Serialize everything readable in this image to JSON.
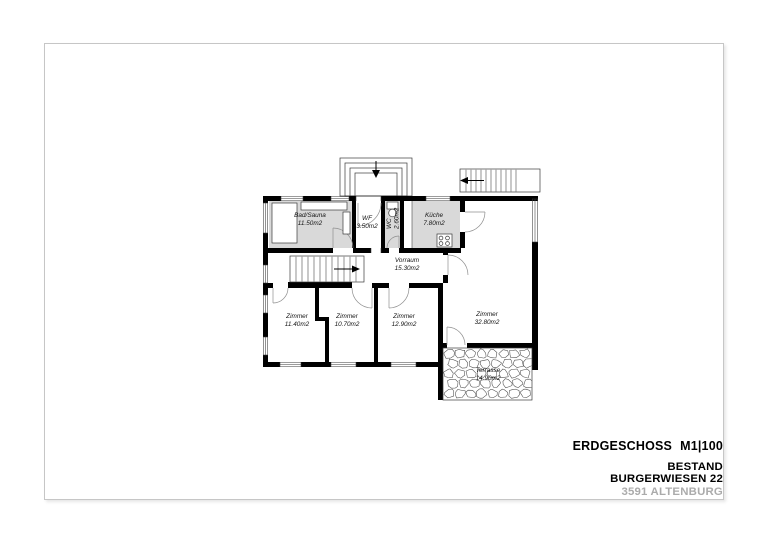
{
  "title_block": {
    "floor_label": "ERDGESCHOSS",
    "scale_label": "M1|100",
    "status_label": "BESTAND",
    "address_street": "BURGERWIESEN 22",
    "address_city": "3591 ALTENBURG"
  },
  "plan": {
    "rooms": [
      {
        "name": "Bad/Sauna",
        "area": "11.50m2"
      },
      {
        "name": "WF",
        "area": "3.50m2"
      },
      {
        "name": "WC",
        "area": "2.60m2"
      },
      {
        "name": "Küche",
        "area": "7.80m2"
      },
      {
        "name": "Vorraum",
        "area": "15.30m2"
      },
      {
        "name": "Zimmer",
        "area": "11.40m2"
      },
      {
        "name": "Zimmer",
        "area": "10.70m2"
      },
      {
        "name": "Zimmer",
        "area": "12.90m2"
      },
      {
        "name": "Zimmer",
        "area": "32.80m2"
      },
      {
        "name": "Terrasse",
        "area": "14.90m2"
      }
    ],
    "colors": {
      "wall": "#000000",
      "wet_room_fill": "#d9d9d9",
      "drawing_line": "#3a3a3a",
      "door_arc": "#8f8f8f",
      "sheet_border": "#c6c6c6",
      "muted_text": "#ababab"
    }
  }
}
